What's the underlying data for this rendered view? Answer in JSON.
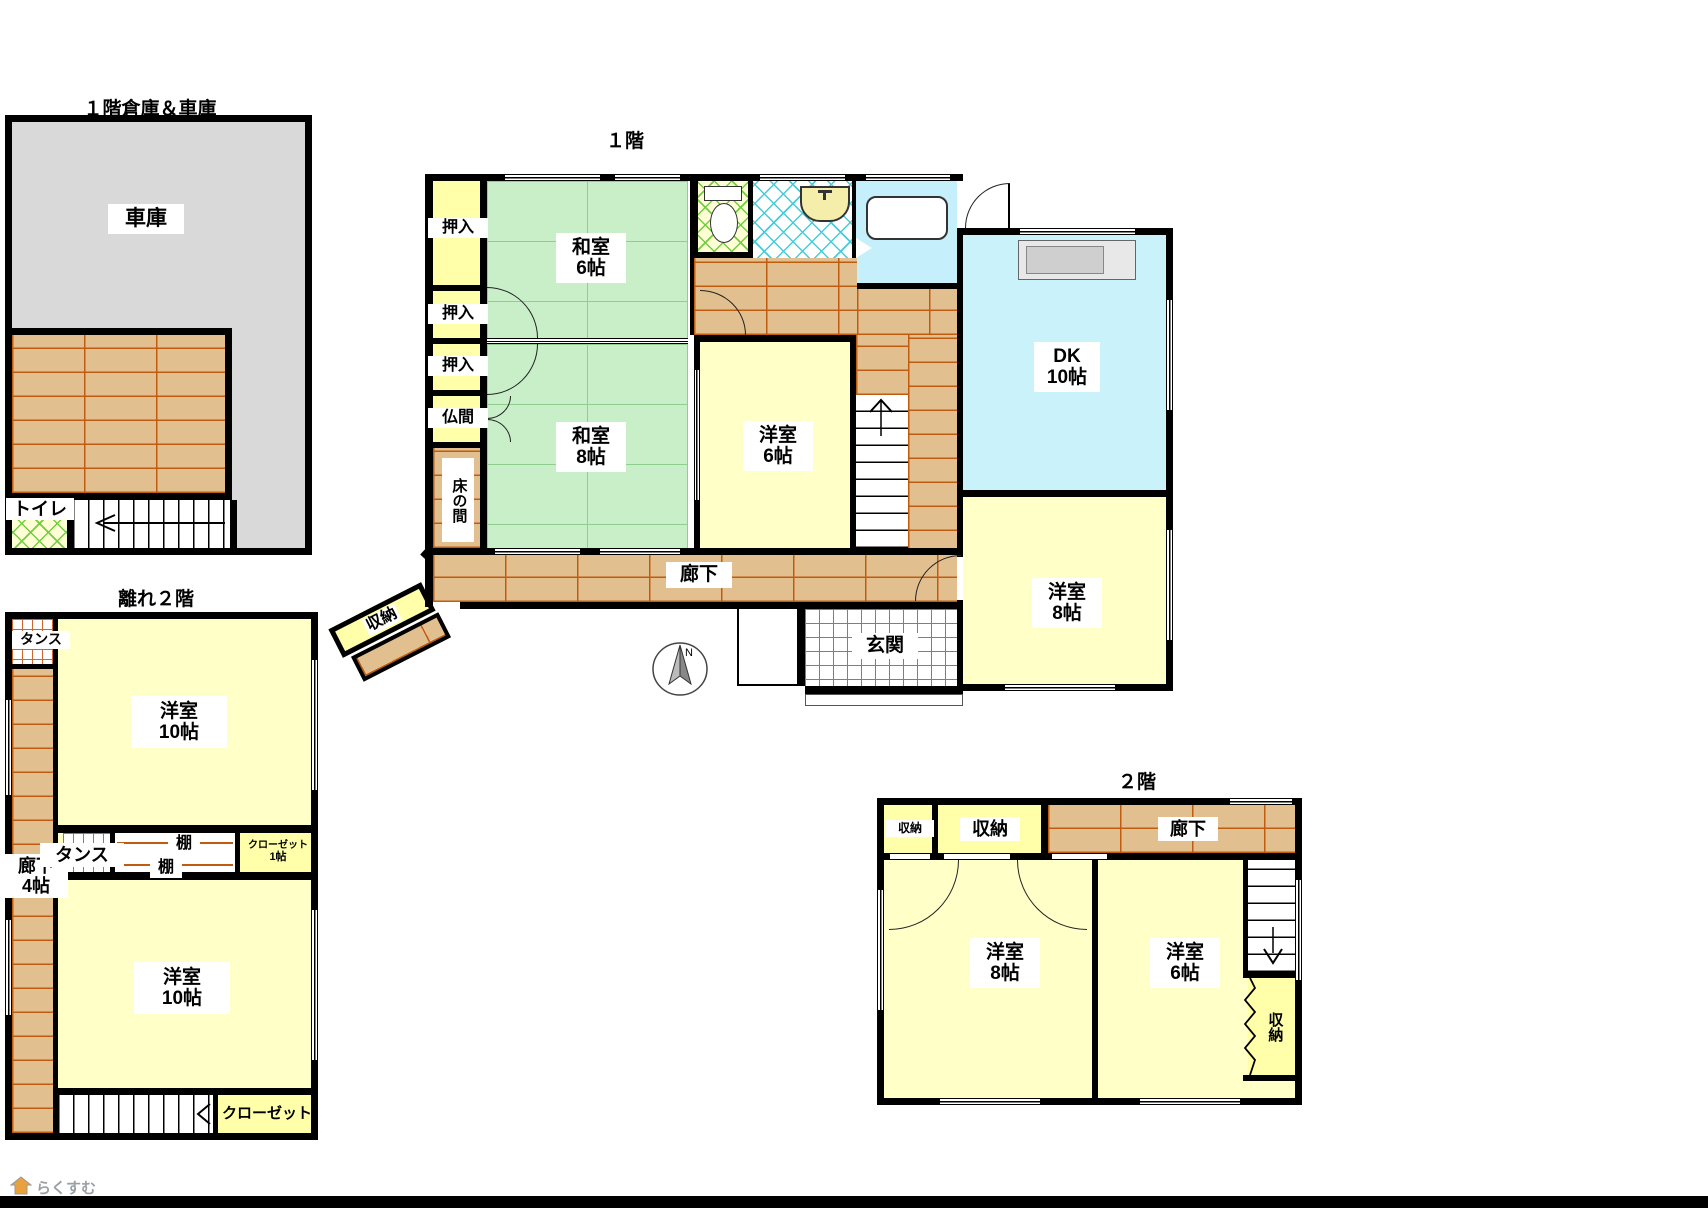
{
  "colors": {
    "tatami": "#c9efc9",
    "tatamiline": "#8fce8f",
    "room": "#ffffc8",
    "closet": "#ffffaa",
    "wood": "#e2bf8e",
    "woodline": "#c05c10",
    "garage": "#d9d9d9",
    "bath": "#c5effb",
    "dk": "#c9f2fa",
    "tile": "#cc6633",
    "hatchg": "#6fcf3f",
    "hatchc": "#45ccd9",
    "counter": "#cfcfcf"
  },
  "garage_bldg": {
    "title": "１階倉庫＆車庫",
    "garage": "車庫",
    "toilet": "トイレ"
  },
  "f1": {
    "title": "１階",
    "oshiire1": "押入",
    "oshiire2": "押入",
    "oshiire3": "押入",
    "butsuma": "仏間",
    "tokonoma": "床の間",
    "washitsu6": {
      "name": "和室",
      "size": "6帖"
    },
    "washitsu8": {
      "name": "和室",
      "size": "8帖"
    },
    "yoshitsu6": {
      "name": "洋室",
      "size": "6帖"
    },
    "dk": {
      "name": "DK",
      "size": "10帖"
    },
    "yoshitsu8": {
      "name": "洋室",
      "size": "8帖"
    },
    "rouka": "廊下",
    "genkan": "玄関",
    "storage_diag": "収納"
  },
  "annex2f": {
    "title": "離れ２階",
    "tansu_top": "タンス",
    "rouka": {
      "name": "廊下",
      "size": "4帖"
    },
    "room_a": {
      "name": "洋室",
      "size": "10帖"
    },
    "tansu_mid": "タンス",
    "shelf1": "棚",
    "shelf2": "棚",
    "closet1": {
      "name": "クローゼット",
      "size": "1帖"
    },
    "room_b": {
      "name": "洋室",
      "size": "10帖"
    },
    "closet2": "クローゼット"
  },
  "f2": {
    "title": "２階",
    "storage_s": "収納",
    "storage_l": "収納",
    "rouka": "廊下",
    "yoshitsu8": {
      "name": "洋室",
      "size": "8帖"
    },
    "yoshitsu6": {
      "name": "洋室",
      "size": "6帖"
    },
    "storage_r": "収納"
  },
  "compass": {
    "north": "N"
  },
  "footer": {
    "brand": "らくすむ"
  }
}
